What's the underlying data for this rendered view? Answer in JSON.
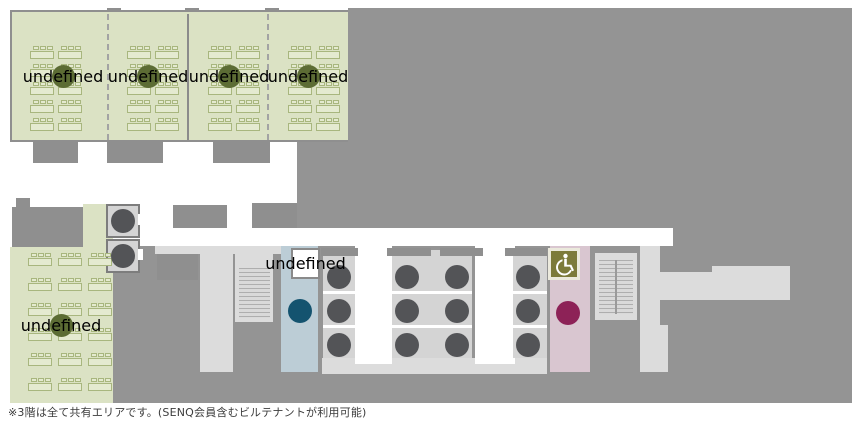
{
  "caption": "※3階は全て共有エリアです。(SENQ会員含むビルテナントが利用可能)",
  "palette": {
    "floor_gray": "#949494",
    "corridor_light": "#dcdcdc",
    "room_green": "#dbe2c4",
    "mens_room_blue": "#bccdd6",
    "womens_room_pink": "#d9c6d0",
    "meeting_circle": "#5c6c34",
    "elevator_circle": "#535457",
    "male_circle": "#14536f",
    "female_circle": "#8d2257",
    "accessible_olive": "#7c7a3a",
    "kettle_glyph": "#4a4a4a"
  },
  "zones": {
    "open_meeting_area_top": {
      "icon": "meeting-table-icon",
      "sections": 4,
      "desk_rows": 5,
      "desk_cols_per_section": 2
    },
    "open_meeting_area_bottom": {
      "icon": "meeting-table-icon",
      "desk_rows": 6,
      "desk_cols": 3
    },
    "elevator_bank": {
      "icon": "elevator-icon",
      "columns": 4,
      "rows": 3
    },
    "nw_elevators": {
      "icon": "elevator-icon",
      "count": 2
    },
    "mens_restroom": {
      "icon": "male-icon"
    },
    "womens_restroom": {
      "icon": "female-icon"
    },
    "accessible_restroom": {
      "icon": "wheelchair-icon"
    },
    "pantry": {
      "icon": "kettle-icon"
    },
    "stairs": {
      "count": 2
    }
  }
}
